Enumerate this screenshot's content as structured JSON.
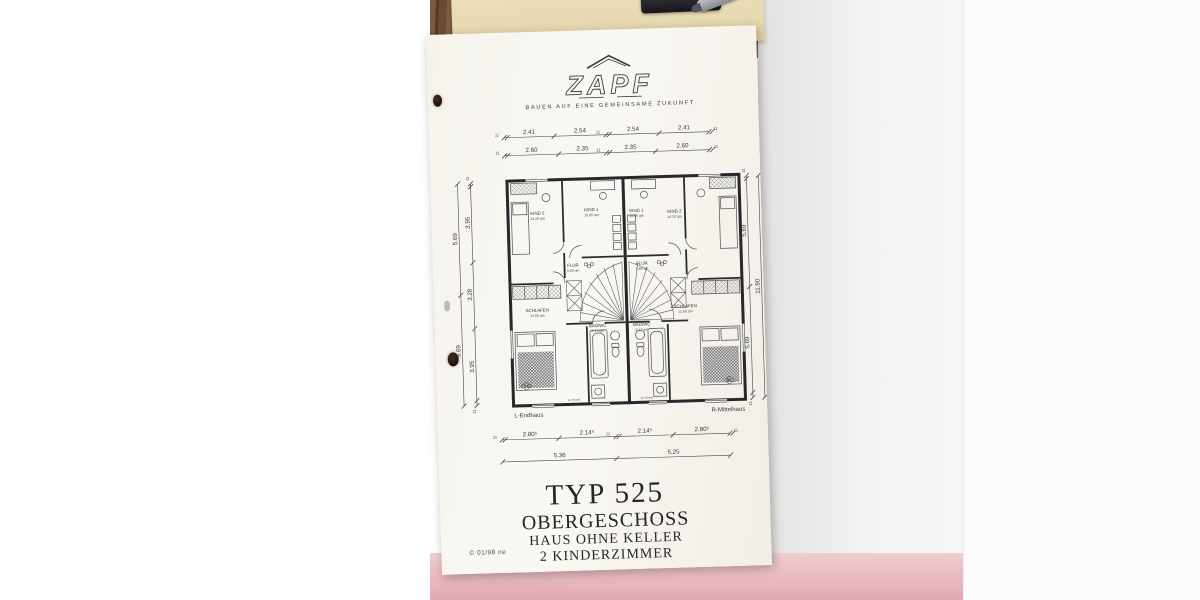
{
  "colors": {
    "paper": "#f7f5ef",
    "ink": "#3a3a3e",
    "pink_surface": "#eec5cb",
    "wood": "#6e4e36",
    "folder": "#e9ddb4"
  },
  "logo": {
    "brand": "ZAPF",
    "tagline": "BAUEN AUF EINE GEMEINSAME ZUKUNFT"
  },
  "dims": {
    "wall_mark": "11",
    "top_row1": [
      "2.41",
      "2.54",
      "2.54",
      "2.41"
    ],
    "top_row2": [
      "2.60",
      "2.35",
      "2.35",
      "2.60"
    ],
    "bottom_row1": [
      "2.80⁵",
      "2.14⁵",
      "2.14⁵",
      "2.80⁵"
    ],
    "bottom_row2": [
      "5.36",
      "5.25"
    ],
    "left_inner": [
      "3.95",
      "3.28",
      "3.95"
    ],
    "left_outer": [
      "5.69",
      "5.69"
    ],
    "right_inner": [
      "5.69",
      "5.69"
    ],
    "right_total": "11.90"
  },
  "plan": {
    "panel_label": "W.-Paneel",
    "units": [
      {
        "label": "L-Endhaus",
        "rooms": [
          {
            "name": "KIND 2",
            "area": "14.20 qm"
          },
          {
            "name": "KIND 1",
            "area": "10.65 qm"
          },
          {
            "name": "FLUR",
            "area": "3.69 qm"
          },
          {
            "name": "SCHLAFEN",
            "area": "13.50 qm"
          },
          {
            "name": "BAD/WC",
            "area": "8.13 qm"
          }
        ]
      },
      {
        "label": "R-Mittelhaus",
        "rooms": [
          {
            "name": "KIND 2",
            "area": "14.20 qm"
          },
          {
            "name": "KIND 1",
            "area": "10.65 qm"
          },
          {
            "name": "FLUR",
            "area": "3.69 qm"
          },
          {
            "name": "SCHLAFEN",
            "area": "13.50 qm"
          },
          {
            "name": "BAD/WC",
            "area": "8.13 qm"
          }
        ]
      }
    ]
  },
  "title_block": {
    "type": "TYP 525",
    "floor": "OBERGESCHOSS",
    "line3": "HAUS OHNE KELLER",
    "line4": "2 KINDERZIMMER"
  },
  "copyright": "© 01/98 ne"
}
